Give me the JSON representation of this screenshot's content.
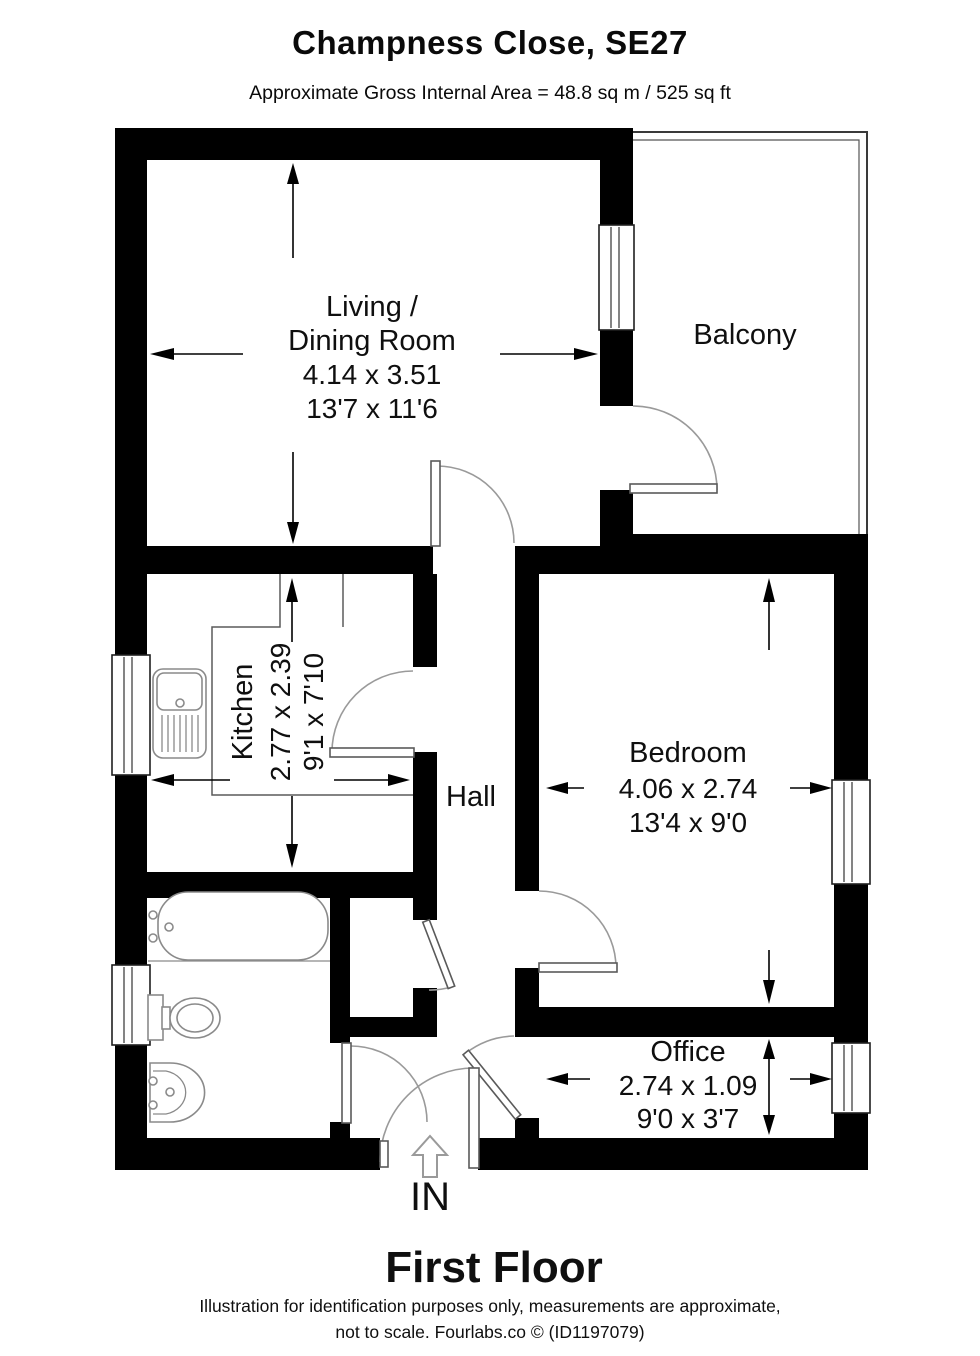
{
  "header": {
    "title": "Champness Close, SE27",
    "subtitle": "Approximate Gross Internal Area = 48.8 sq m / 525 sq ft"
  },
  "rooms": {
    "living_dining": {
      "name_line1": "Living /",
      "name_line2": "Dining Room",
      "size_metric": "4.14 x 3.51",
      "size_imperial": "13'7 x 11'6"
    },
    "balcony": {
      "name": "Balcony"
    },
    "kitchen": {
      "name": "Kitchen",
      "size_metric": "2.77 x 2.39",
      "size_imperial": "9'1 x 7'10"
    },
    "hall": {
      "name": "Hall"
    },
    "bedroom": {
      "name": "Bedroom",
      "size_metric": "4.06 x 2.74",
      "size_imperial": "13'4 x 9'0"
    },
    "office": {
      "name": "Office",
      "size_metric": "2.74 x 1.09",
      "size_imperial": "9'0 x 3'7"
    }
  },
  "entrance": {
    "label": "IN"
  },
  "floor": {
    "label": "First Floor"
  },
  "footer": {
    "line1": "Illustration for identification purposes only, measurements are approximate,",
    "line2": "not to scale. Fourlabs.co © (ID1197079)"
  },
  "colors": {
    "wall": "#000000",
    "background": "#ffffff",
    "text": "#111111",
    "fixture_line": "#8a8a8a",
    "door_arc": "#9a9a9a"
  }
}
